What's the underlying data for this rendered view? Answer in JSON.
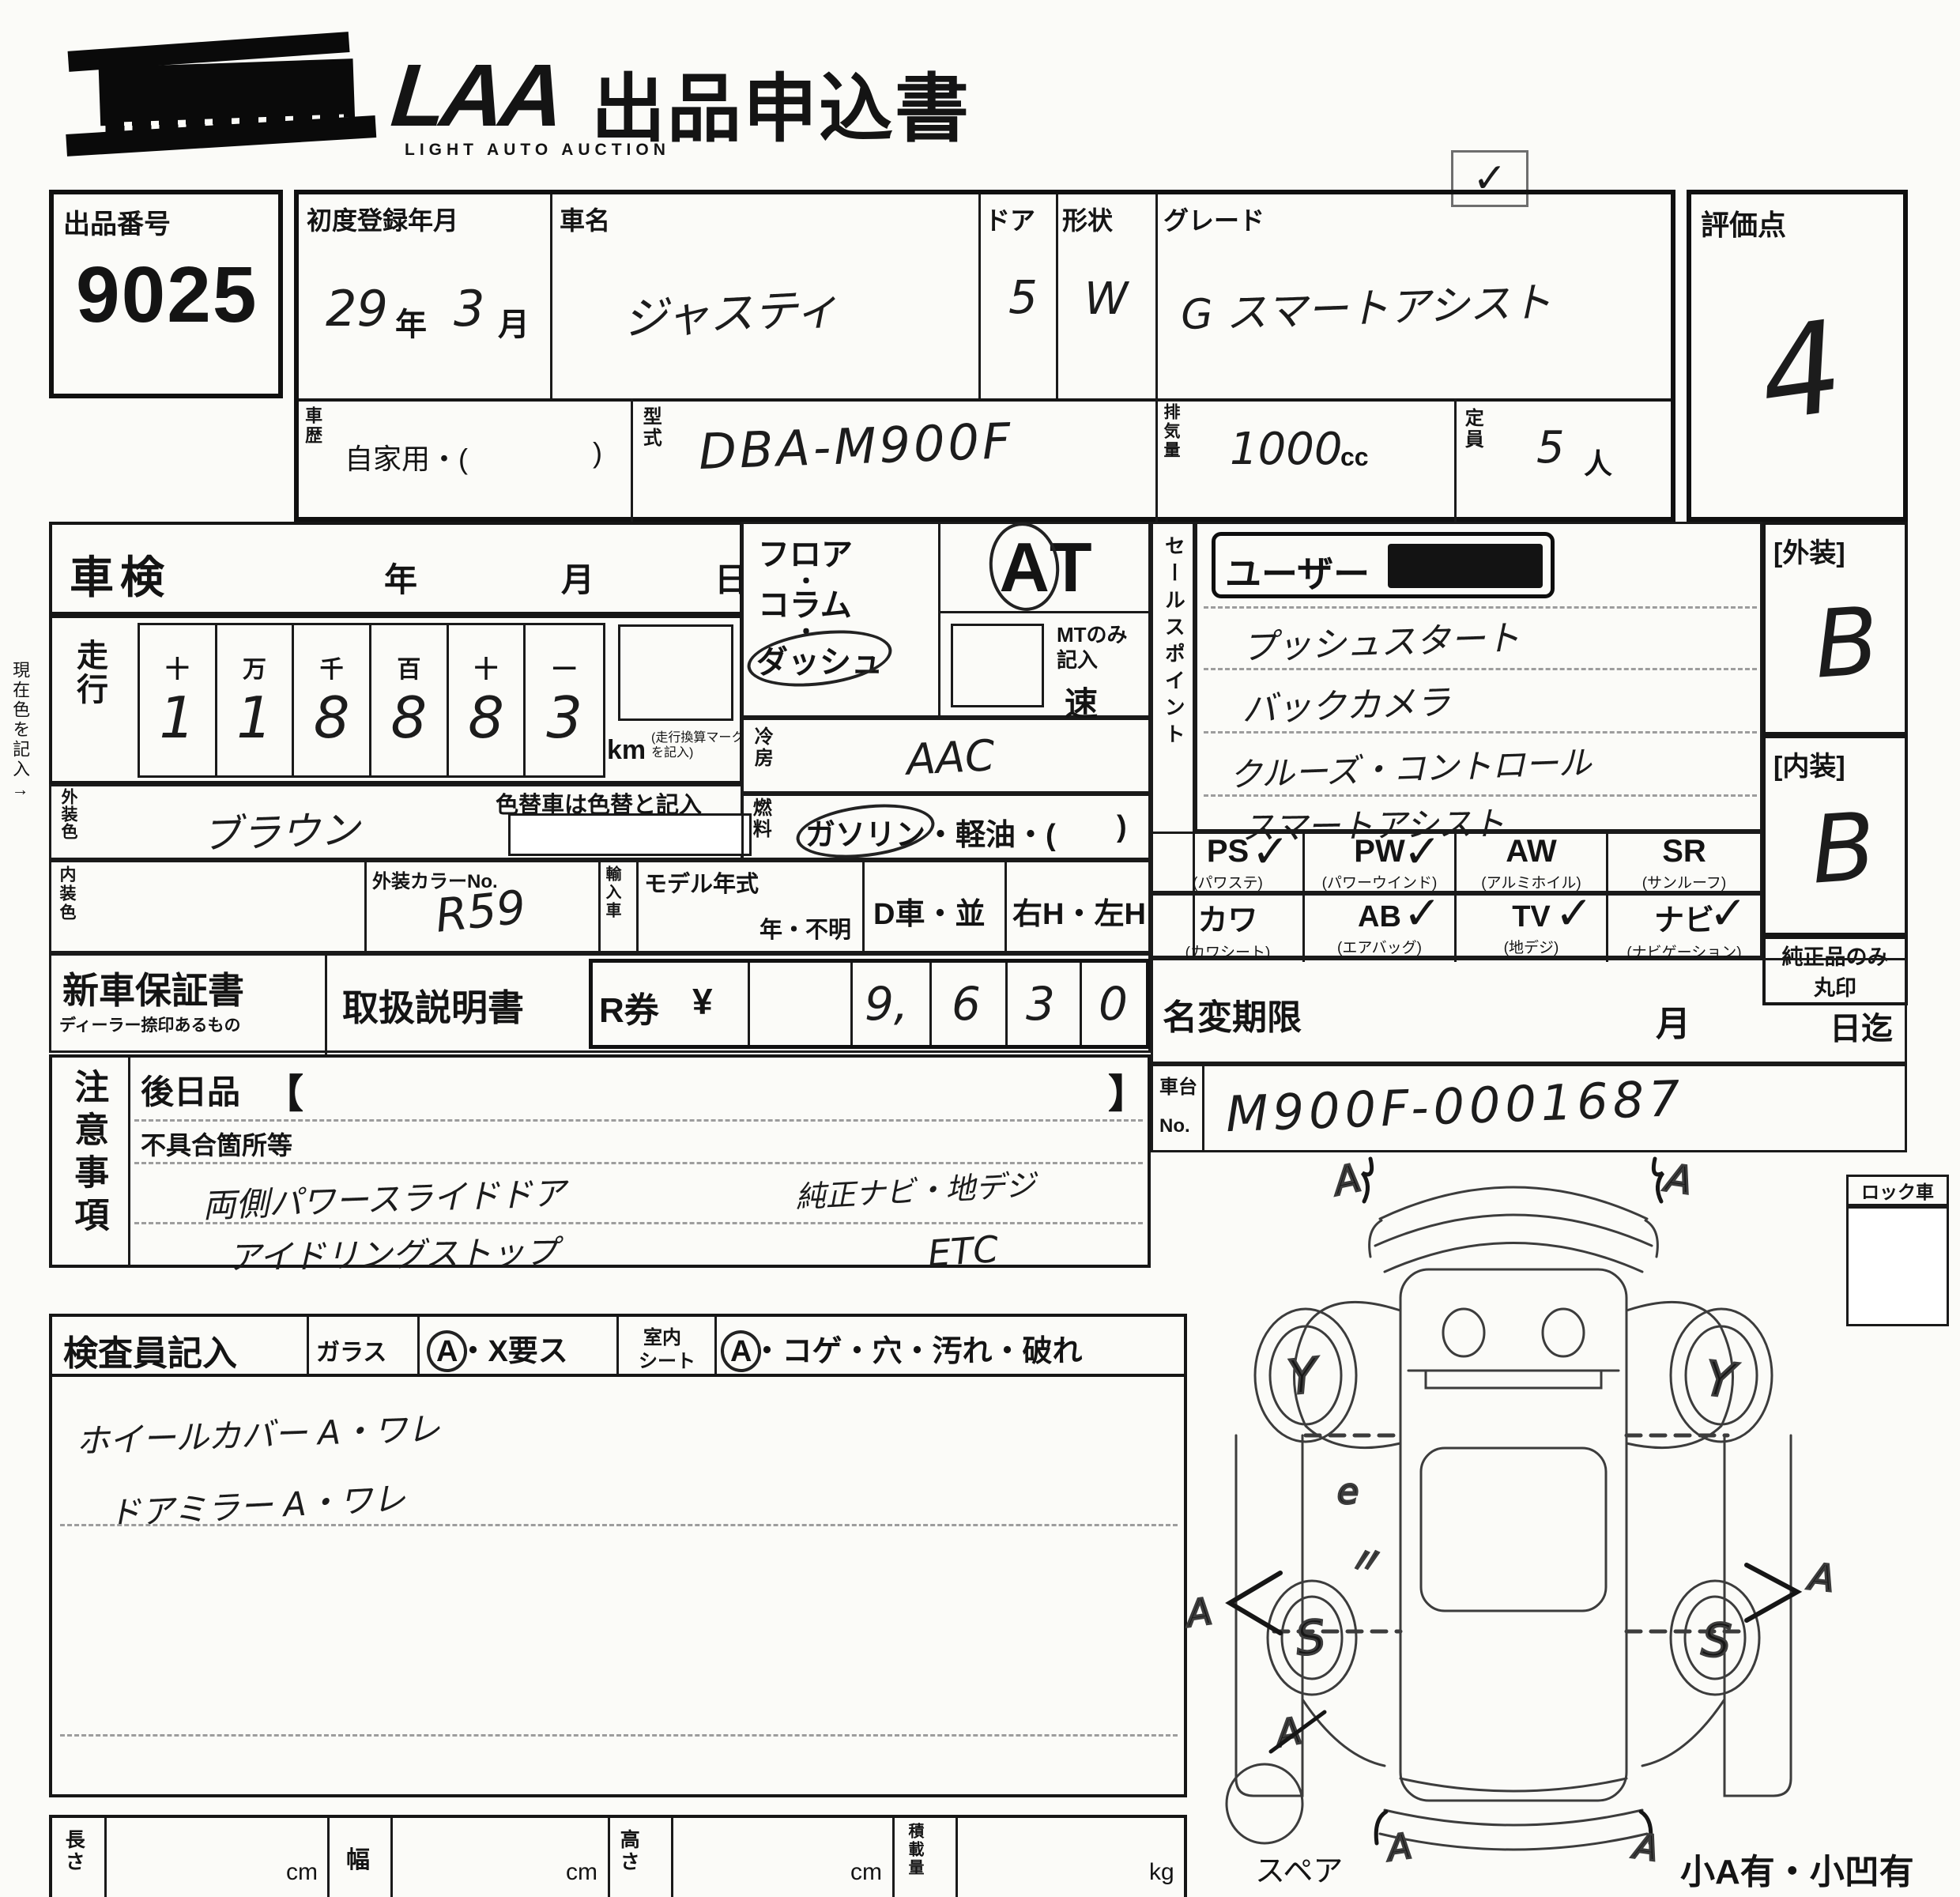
{
  "header": {
    "logo_main": "LAA",
    "logo_sub": "LIGHT AUTO AUCTION",
    "title": "出品申込書",
    "check_mark": "✓"
  },
  "lot": {
    "label": "出品番号",
    "number": "9025"
  },
  "registration": {
    "label": "初度登録年月",
    "year_value": "29",
    "year_unit": "年",
    "month_value": "3",
    "month_unit": "月"
  },
  "car_name": {
    "label": "車名",
    "value": "ジャスティ"
  },
  "doors": {
    "label": "ドア",
    "value": "5"
  },
  "shape": {
    "label": "形状",
    "value": "W"
  },
  "grade": {
    "label": "グレード",
    "value": "G スマートアシスト"
  },
  "score": {
    "label": "評価点",
    "value": "4"
  },
  "history": {
    "label": "車歴",
    "text": "自家用・(",
    "close": ")"
  },
  "model_code": {
    "label": "型式",
    "value": "DBA-M900F"
  },
  "displacement": {
    "label": "排気量",
    "value": "1000",
    "unit": "cc"
  },
  "capacity": {
    "label": "定員",
    "value": "5",
    "unit": "人"
  },
  "inspection": {
    "label": "車検",
    "year": "年",
    "month": "月",
    "day": "日"
  },
  "mileage": {
    "label": "走行",
    "digit_headers": [
      "十",
      "万",
      "千",
      "百",
      "十",
      "一"
    ],
    "digits": [
      "1",
      "1",
      "8",
      "8",
      "8",
      "3"
    ],
    "unit": "km",
    "note": "(走行換算マーク を記入)"
  },
  "side_note": "現在色を記入→",
  "exterior_color": {
    "label": "外装色",
    "value": "ブラウン"
  },
  "color_change_note": "色替車は色替と記入",
  "interior_color_label": "内装色",
  "color_no": {
    "label": "外装カラーNo.",
    "value": "R59"
  },
  "import_label": "輸入車",
  "model_year": {
    "label": "モデル年式",
    "value": "年・不明"
  },
  "d_car": "D車・並",
  "handle": "右H・左H",
  "ac": {
    "label": "冷房",
    "value": "AAC"
  },
  "fuel": {
    "label": "燃料",
    "opt1": "ガソリン",
    "rest": "・軽油・(",
    "close": ")"
  },
  "shift": {
    "floor": "フロア",
    "dot1": "・",
    "column": "コラム",
    "dot2": "・",
    "dash": "ダッシュ",
    "at": "AT",
    "mt_note_1": "MTのみ",
    "mt_note_2": "記入",
    "speed": "速"
  },
  "docs": {
    "warranty": "新車保証書",
    "warranty_sub": "ディーラー捺印あるもの",
    "manual": "取扱説明書",
    "r_label": "R券",
    "yen": "¥",
    "amount": [
      "",
      "9,",
      "6",
      "3",
      "0"
    ]
  },
  "sales": {
    "strip_label": "セールスポイント",
    "stamp": "ユーザー",
    "lines": [
      "プッシュスタート",
      "バックカメラ",
      "クルーズ・コントロール",
      "スマートアシスト"
    ]
  },
  "equipment": {
    "rows": [
      [
        {
          "code": "PS",
          "name": "(パワステ)",
          "mark": "✓"
        },
        {
          "code": "PW",
          "name": "(パワーウインド)",
          "mark": "✓"
        },
        {
          "code": "AW",
          "name": "(アルミホイル)",
          "mark": ""
        },
        {
          "code": "SR",
          "name": "(サンルーフ)",
          "mark": ""
        }
      ],
      [
        {
          "code": "カワ",
          "name": "(カワシート)",
          "mark": ""
        },
        {
          "code": "AB",
          "name": "(エアバッグ)",
          "mark": "✓"
        },
        {
          "code": "TV",
          "name": "(地デジ)",
          "mark": "✓"
        },
        {
          "code": "ナビ",
          "name": "(ナビゲーション)",
          "mark": "✓"
        }
      ]
    ]
  },
  "grades": {
    "exterior_label": "[外装]",
    "exterior_value": "B",
    "interior_label": "[内装]",
    "interior_value": "B",
    "genuine_1": "純正品のみ",
    "genuine_2": "丸印"
  },
  "name_change": {
    "label": "名変期限",
    "month": "月",
    "until": "日迄"
  },
  "chassis": {
    "label_top": "車台",
    "label_bottom": "No.",
    "value": "M900F-0001687"
  },
  "lock_label": "ロック車",
  "notes": {
    "strip_label": "注意事項",
    "later": "後日品",
    "bro": "【",
    "brc": "】",
    "defect": "不具合箇所等",
    "line1": "両側パワースライドドア",
    "line2": "アイドリングストップ",
    "line3": "純正ナビ・地デジ",
    "line4": "ETC"
  },
  "inspector": {
    "label": "検査員記入",
    "glass": "ガラス",
    "glass_a": "A",
    "glass_rest": "・X要ス",
    "seat_1": "室内",
    "seat_2": "シート",
    "seat_a": "A",
    "seat_rest": "・コゲ・穴・汚れ・破れ",
    "line1": "ホイールカバー A・ワレ",
    "line2": "ドアミラー A・ワレ"
  },
  "dimensions": {
    "length": "長さ",
    "length_unit": "cm",
    "width": "幅",
    "width_unit": "cm",
    "height": "高さ",
    "height_unit": "cm",
    "load": "積載量",
    "load_unit": "kg"
  },
  "spare_label": "スペア",
  "corner_note": "小A有・小凹有",
  "diagram": {
    "front_left": "A",
    "front_right": "A",
    "wheel_fl": "Y",
    "wheel_fr": "Y",
    "side_left_a": "A",
    "side_right_a": "A",
    "mark_e": "e",
    "mark_quote": "〃",
    "mark_rear_left_a": "A",
    "wheel_rl": "S",
    "wheel_rr": "S",
    "rear_left": "A",
    "rear_right": "A"
  }
}
